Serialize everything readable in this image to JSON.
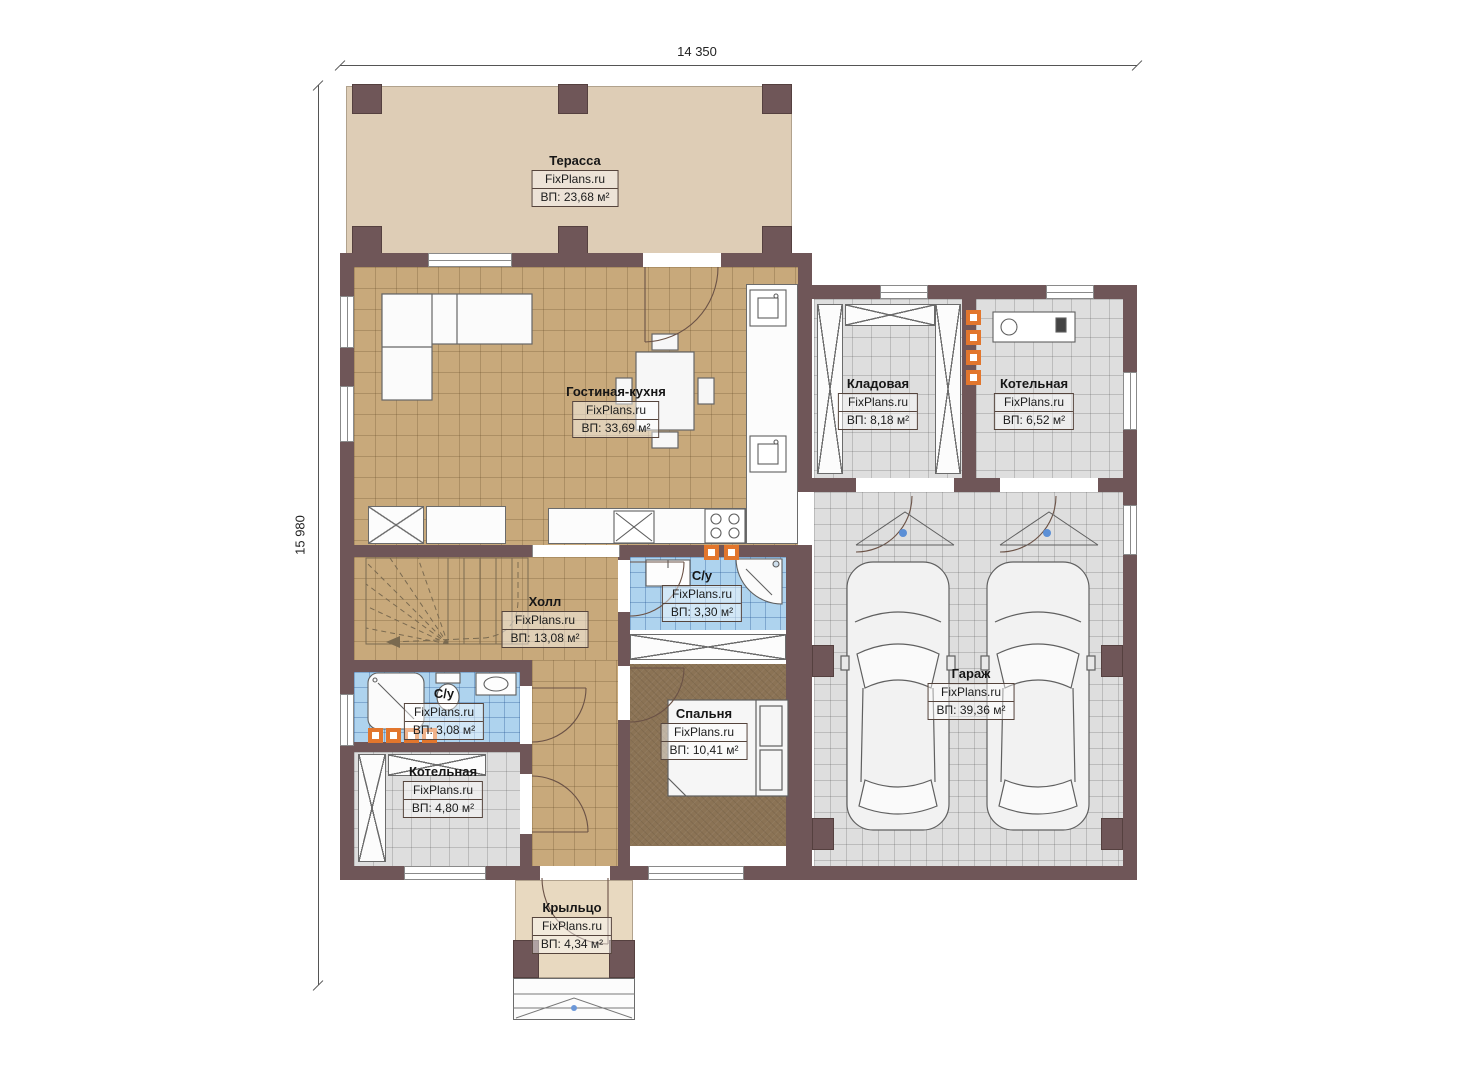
{
  "brand": "FixPlans.ru",
  "dimensions": {
    "width_label": "14 350",
    "height_label": "15 980"
  },
  "rooms": {
    "terrace": {
      "name": "Терасса",
      "area": "ВП: 23,68 м²"
    },
    "living_kitchen": {
      "name": "Гостиная-кухня",
      "area": "ВП: 33,69 м²"
    },
    "storage": {
      "name": "Кладовая",
      "area": "ВП: 8,18 м²"
    },
    "boiler_top": {
      "name": "Котельная",
      "area": "ВП: 6,52 м²"
    },
    "hall": {
      "name": "Холл",
      "area": "ВП: 13,08 м²"
    },
    "bath_main": {
      "name": "С/у",
      "area": "ВП: 3,30 м²"
    },
    "bath_small": {
      "name": "С/у",
      "area": "ВП: 3,08 м²"
    },
    "boiler_bottom": {
      "name": "Котельная",
      "area": "ВП: 4,80 м²"
    },
    "bedroom": {
      "name": "Спальня",
      "area": "ВП: 10,41 м²"
    },
    "garage": {
      "name": "Гараж",
      "area": "ВП: 39,36 м²"
    },
    "porch": {
      "name": "Крыльцо",
      "area": "ВП: 4,34 м²"
    }
  },
  "colors": {
    "wall": "#6f5658",
    "floor-wood": "#c8a97b",
    "floor-tile": "#dedede",
    "floor-blue": "#aed3ee",
    "floor-bedroom": "#8b7355",
    "floor-terrace": "#decdb6",
    "floor-porch": "#e8d9c0",
    "radiator": "#e2762d"
  }
}
